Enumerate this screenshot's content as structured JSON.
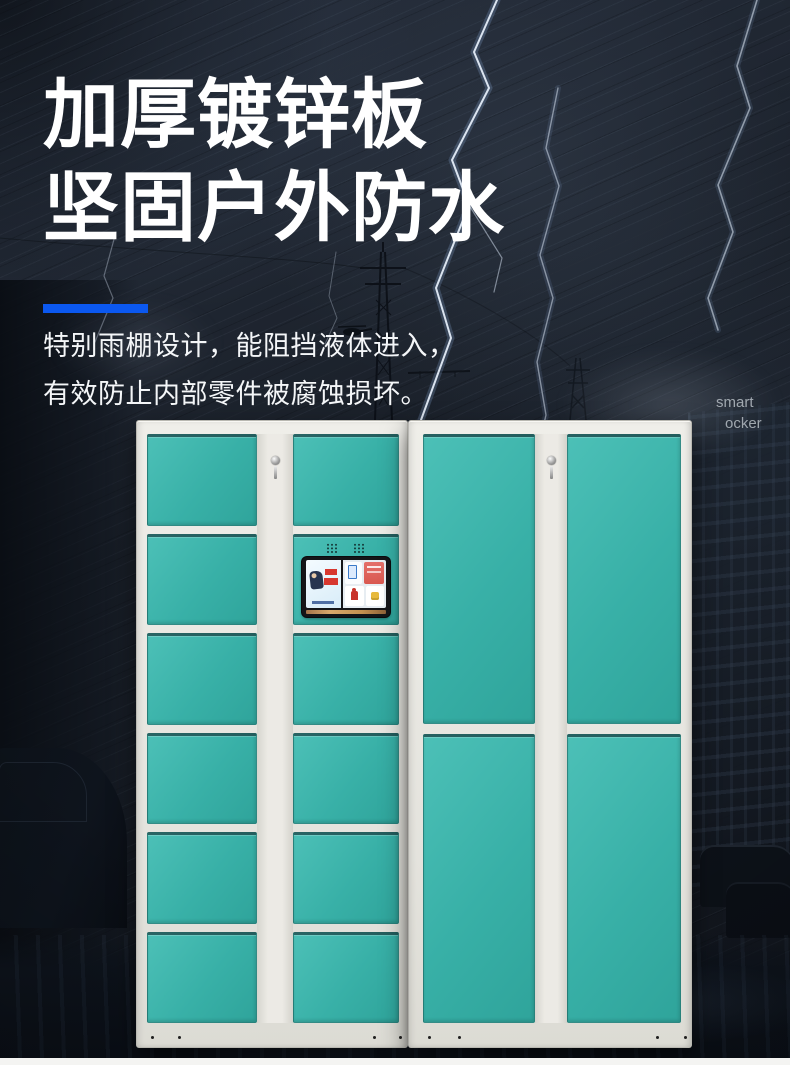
{
  "hero": {
    "title_line1": "加厚镀锌板",
    "title_line2": "坚固户外防水",
    "subtitle_line1": "特别雨棚设计，能阻挡液体进入，",
    "subtitle_line2": "有效防止内部零件被腐蚀损坏。",
    "accent_color": "#0b58f0"
  },
  "watermark": {
    "line1": "smart",
    "line2": "ocker"
  },
  "colors": {
    "background_dark": "#161c26",
    "door_teal": "#3bb3aa",
    "frame_white": "#e9e8e3",
    "accent_blue": "#0b58f0",
    "screen_bezel": "#141518"
  },
  "icons": [
    "lightning-icon",
    "transmission-tower-icon",
    "helicopter-icon",
    "keyhole-icon",
    "speaker-holes-icon"
  ],
  "locker": {
    "cabinets": [
      {
        "side": "left",
        "left": 136,
        "top": 420,
        "width": 272,
        "height": 628,
        "doors_top": 13,
        "base_height": 24,
        "gap": 8,
        "columns": [
          {
            "kind": "doors",
            "left": 10,
            "width": 110,
            "rows": 6
          },
          {
            "kind": "strip",
            "left": 120,
            "width": 36,
            "keyhole": true
          },
          {
            "kind": "doors",
            "left": 156,
            "width": 106,
            "rows": 6,
            "screen_row": 1
          }
        ],
        "dots": [
          14,
          41,
          236,
          262
        ]
      },
      {
        "side": "right",
        "left": 408,
        "top": 420,
        "width": 284,
        "height": 628,
        "doors_top": 13,
        "base_height": 24,
        "gap": 10,
        "columns": [
          {
            "kind": "doors",
            "left": 14,
            "width": 112,
            "rows": 2
          },
          {
            "kind": "strip",
            "left": 126,
            "width": 32,
            "keyhole": true
          },
          {
            "kind": "doors",
            "left": 158,
            "width": 114,
            "rows": 2
          }
        ],
        "dots": [
          19,
          49,
          247,
          275
        ]
      }
    ]
  }
}
